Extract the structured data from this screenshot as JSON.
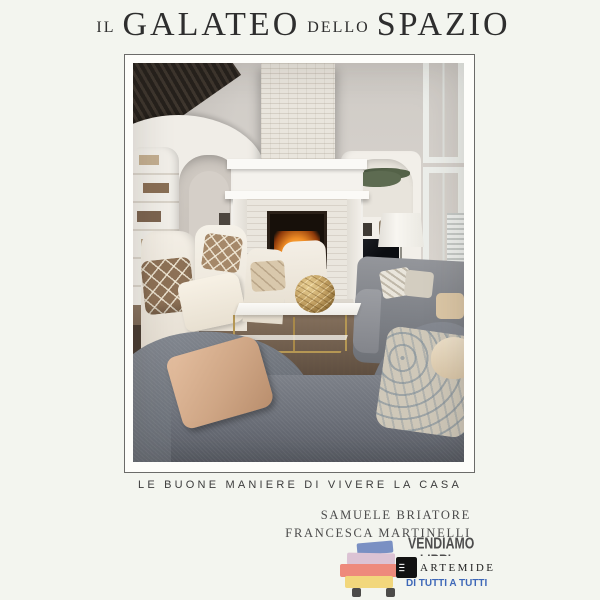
{
  "cover": {
    "title": {
      "small1": "IL",
      "large1": "GALATEO",
      "small2": "DELLO",
      "large2": "SPAZIO"
    },
    "subtitle": "LE BUONE MANIERE DI VIVERE LA CASA",
    "authors": {
      "line1": "SAMUELE BRIATORE",
      "line2": "FRANCESCA MARTINELLI"
    },
    "publisher": {
      "name": "ARTEMIDE"
    }
  },
  "watermark": {
    "line_top": "VENDIAMO",
    "line_mid": "LIBRI",
    "line_bottom": "DI TUTTI A TUTTI"
  },
  "photo": {
    "description": "Bright two-storey living room with white brick fireplace, lit fire, built-in bookshelves, arched hallway, tall windows, TV cabinet, floor lamp, grey sofas, cream wing chairs with patterned pillows, white marble coffee table with gold base and sphere ornament on a beige shaggy rug"
  },
  "colors": {
    "page_bg": "#f3f5ef",
    "frame_border": "#6b6b69",
    "title_text": "#2e2e2e",
    "watermark_gray": "#4d4d4d",
    "watermark_blue": "#3e68b8",
    "book_blue": "#7a90c3",
    "book_pink": "#dcc3d4",
    "book_salmon": "#ee8a7c",
    "book_yellow": "#f2d77c"
  }
}
